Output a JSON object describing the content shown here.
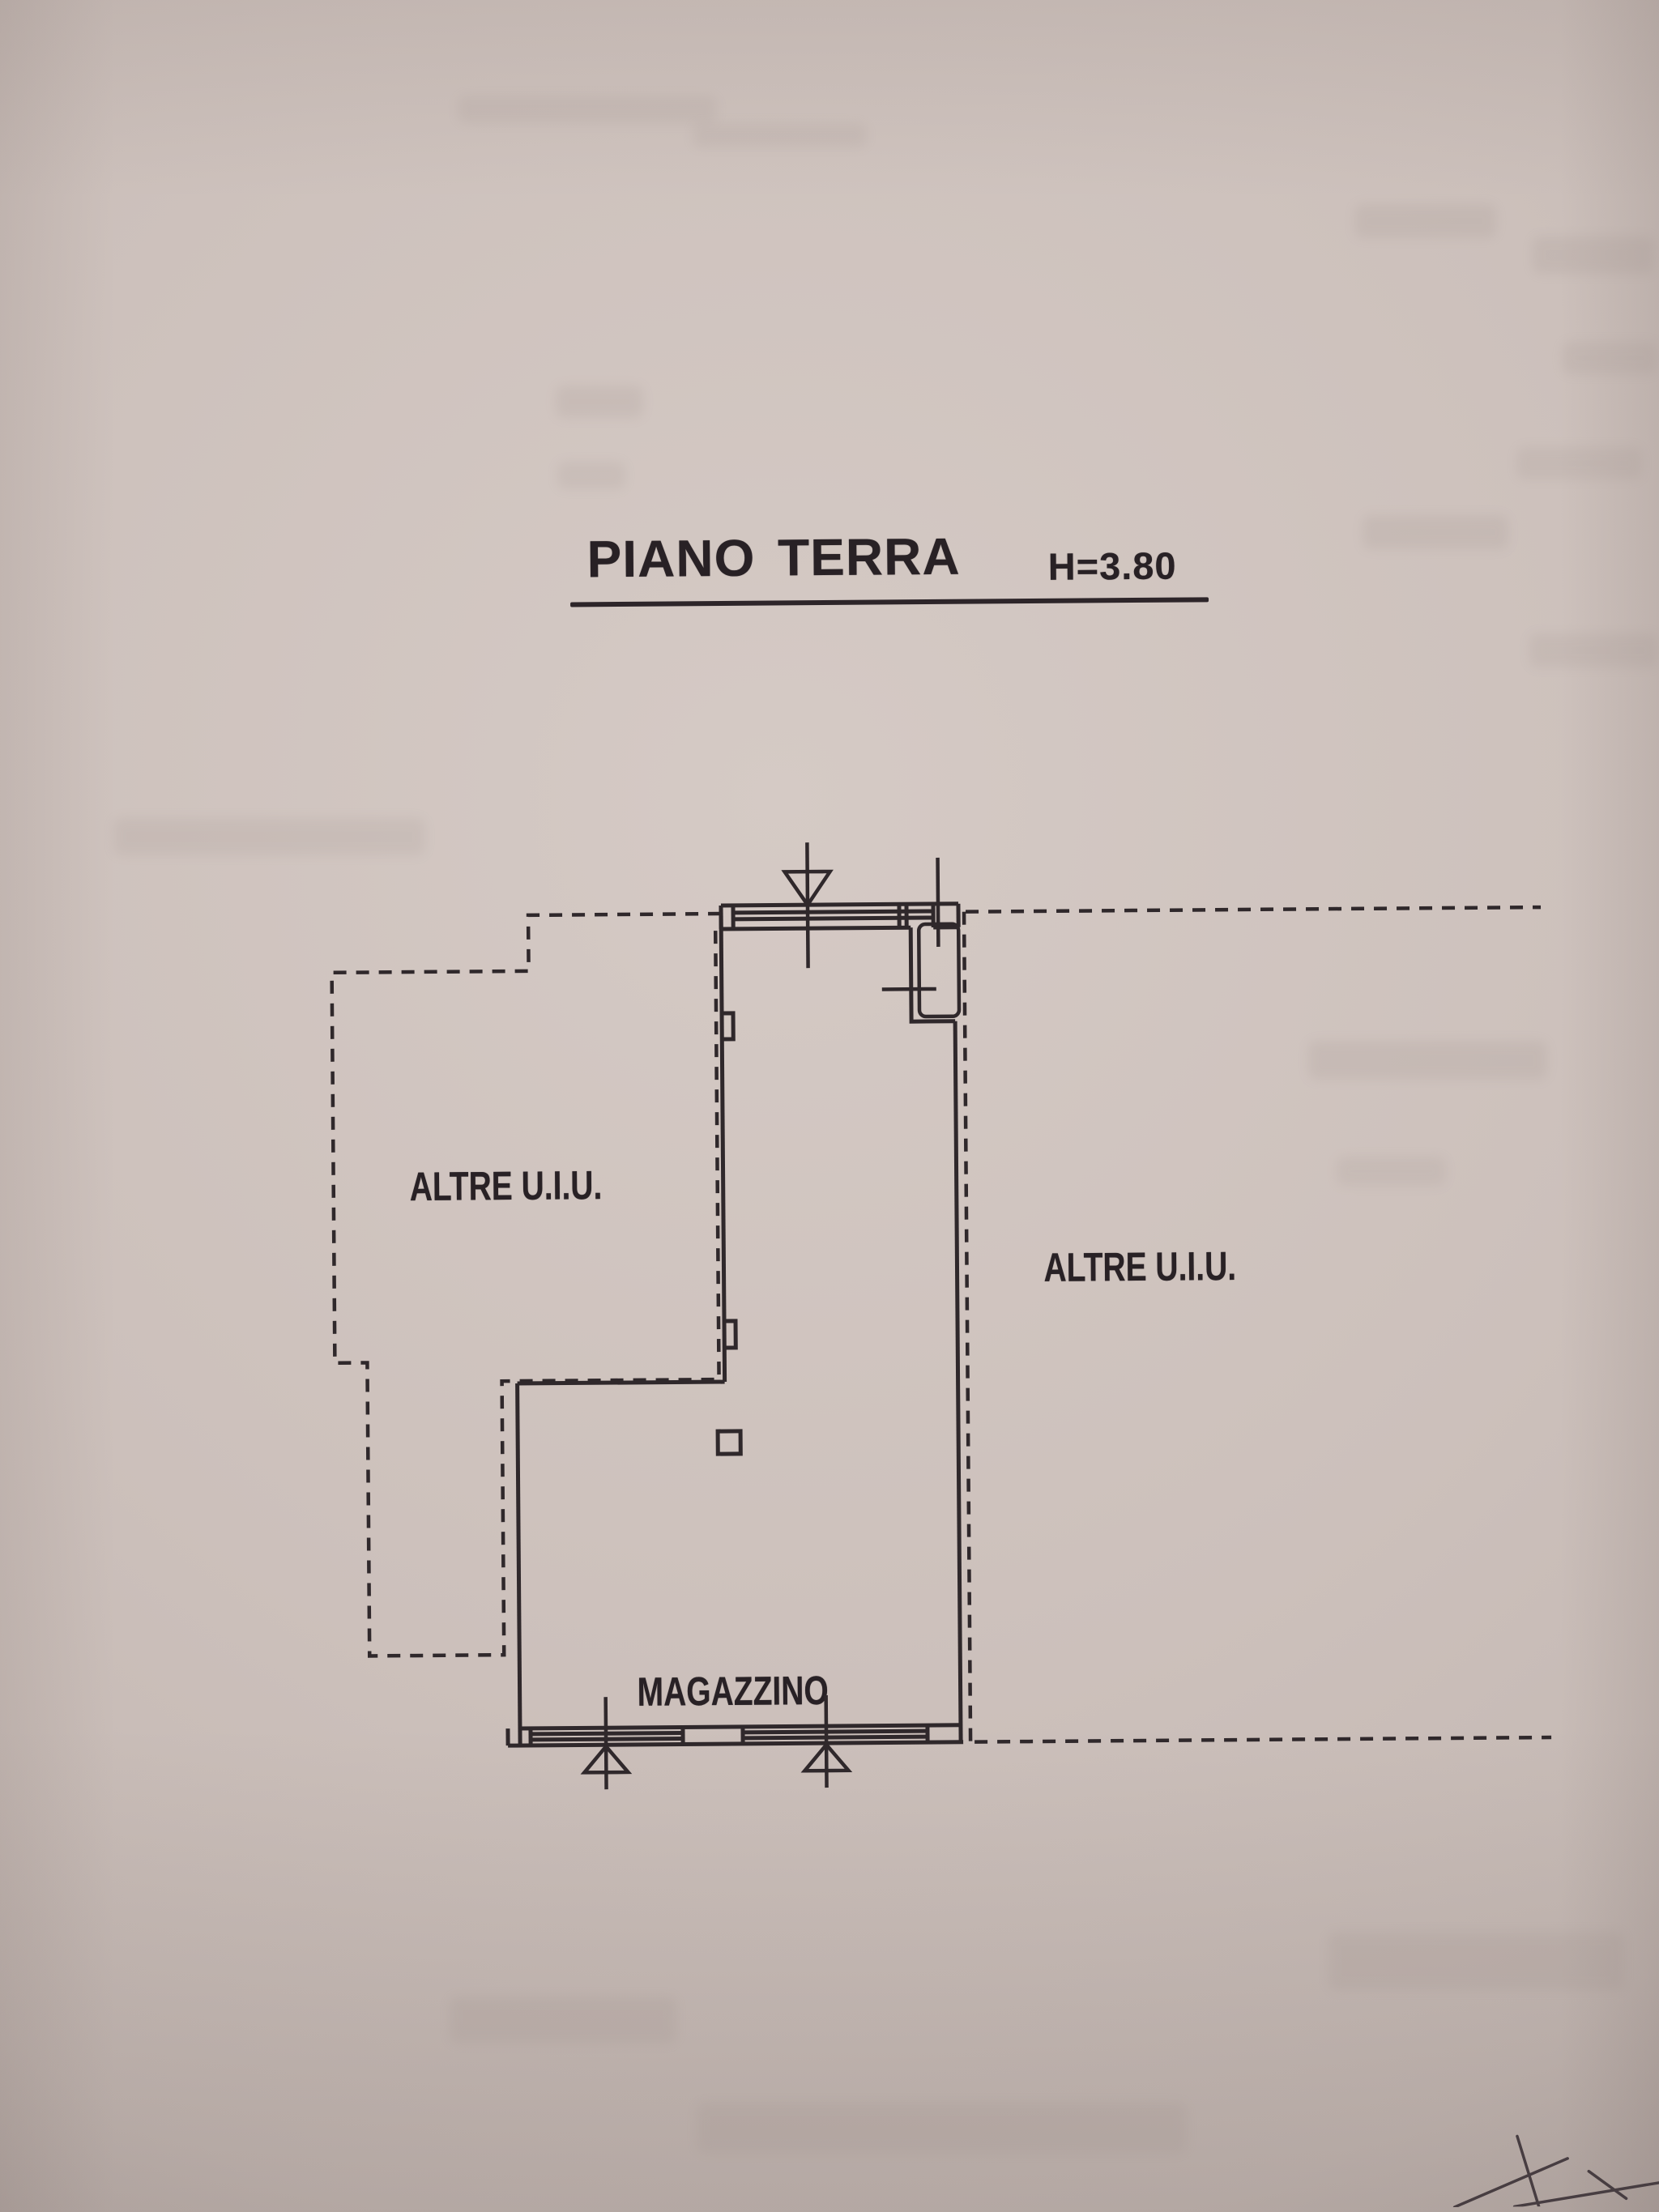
{
  "page": {
    "title": "PIANO TERRA",
    "height_label": "H=3.80",
    "kind": "floor-plan-scan"
  },
  "labels": {
    "left_unit": "ALTRE U.I.U.",
    "right_unit": "ALTRE U.I.U.",
    "storage_room": "MAGAZZINO"
  },
  "symbols": {
    "top_entrance": "door-arrow-down-icon",
    "top_right_window": "window-axis-icon",
    "top_right_door": "door-leaf-icon",
    "bottom_window_left": "window-arrow-up-icon",
    "bottom_window_right": "window-arrow-up-icon",
    "pillar": "pillar-square-icon",
    "corner_mark": "pencil-arrow-sketch-icon"
  },
  "colors": {
    "paper": "#ccc0bb",
    "ink": "#2f282b",
    "pencil": "#473d41"
  }
}
